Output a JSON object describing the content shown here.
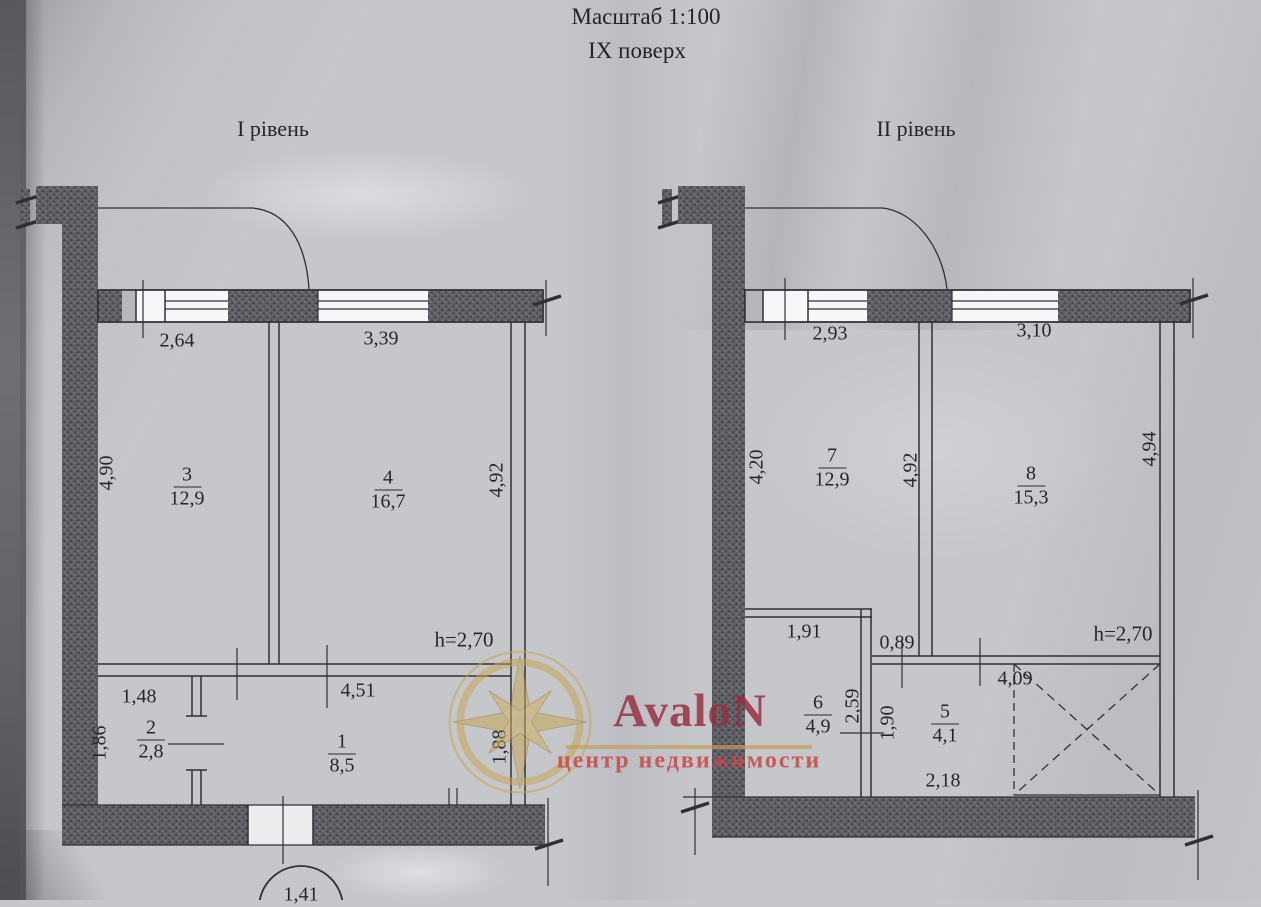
{
  "header": {
    "scale": "Масштаб 1:100",
    "floor": "IX поверх"
  },
  "left_plan": {
    "level_label": "І рівень",
    "ceiling_height": "h=2,70",
    "rooms": [
      {
        "number": "3",
        "area": "12,9"
      },
      {
        "number": "4",
        "area": "16,7"
      },
      {
        "number": "2",
        "area": "2,8"
      },
      {
        "number": "1",
        "area": "8,5"
      }
    ],
    "dims": {
      "window_left": "2,64",
      "window_right": "3,39",
      "wall_left": "4,90",
      "wall_right": "4,92",
      "room2_width": "1,48",
      "room2_depth": "1,86",
      "room1_width": "4,51",
      "right_side": "1,88",
      "entry": "1,41"
    }
  },
  "right_plan": {
    "level_label": "ІІ рівень",
    "ceiling_height": "h=2,70",
    "rooms": [
      {
        "number": "7",
        "area": "12,9"
      },
      {
        "number": "8",
        "area": "15,3"
      },
      {
        "number": "6",
        "area": "4,9"
      },
      {
        "number": "5",
        "area": "4,1"
      }
    ],
    "dims": {
      "window_left": "2,93",
      "window_right": "3,10",
      "wall_left": "4,20",
      "wall_mid": "4,92",
      "wall_right": "4,94",
      "room6_width": "1,91",
      "step": "0,89",
      "hall_width": "4,09",
      "depth1": "2,59",
      "depth2": "1,90",
      "room5_width": "2,18"
    }
  },
  "watermark": {
    "brand": "AvaloN",
    "tagline": "центр недвижимости",
    "brand_color": "#982c3e",
    "accent_color": "#c19f4d"
  }
}
